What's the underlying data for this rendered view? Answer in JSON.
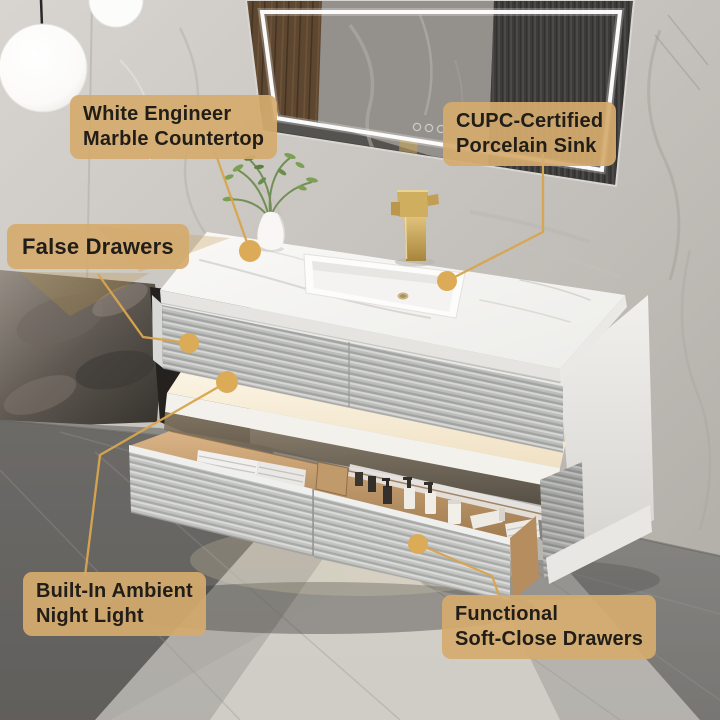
{
  "annotations": {
    "countertop": {
      "text": "White Engineer\nMarble Countertop"
    },
    "sink": {
      "text": "CUPC-Certified\nPorcelain Sink"
    },
    "false_drawers": {
      "text": "False Drawers"
    },
    "night_light": {
      "text": "Built-In Ambient\nNight Light"
    },
    "soft_close": {
      "text": "Functional\nSoft-Close Drawers"
    }
  },
  "style": {
    "label_background": "#d4ab6e",
    "label_text_color": "#211d18",
    "callout_line_color": "#d8a54e",
    "callout_dot_color": "#dcab58",
    "faucet_gold": "#c9a254",
    "cabinet_grey": "#c4c5c3",
    "marble_wall": "#c9c5c0",
    "wood_interior": "#c49a67",
    "night_light_glow": "#f6ead3"
  }
}
